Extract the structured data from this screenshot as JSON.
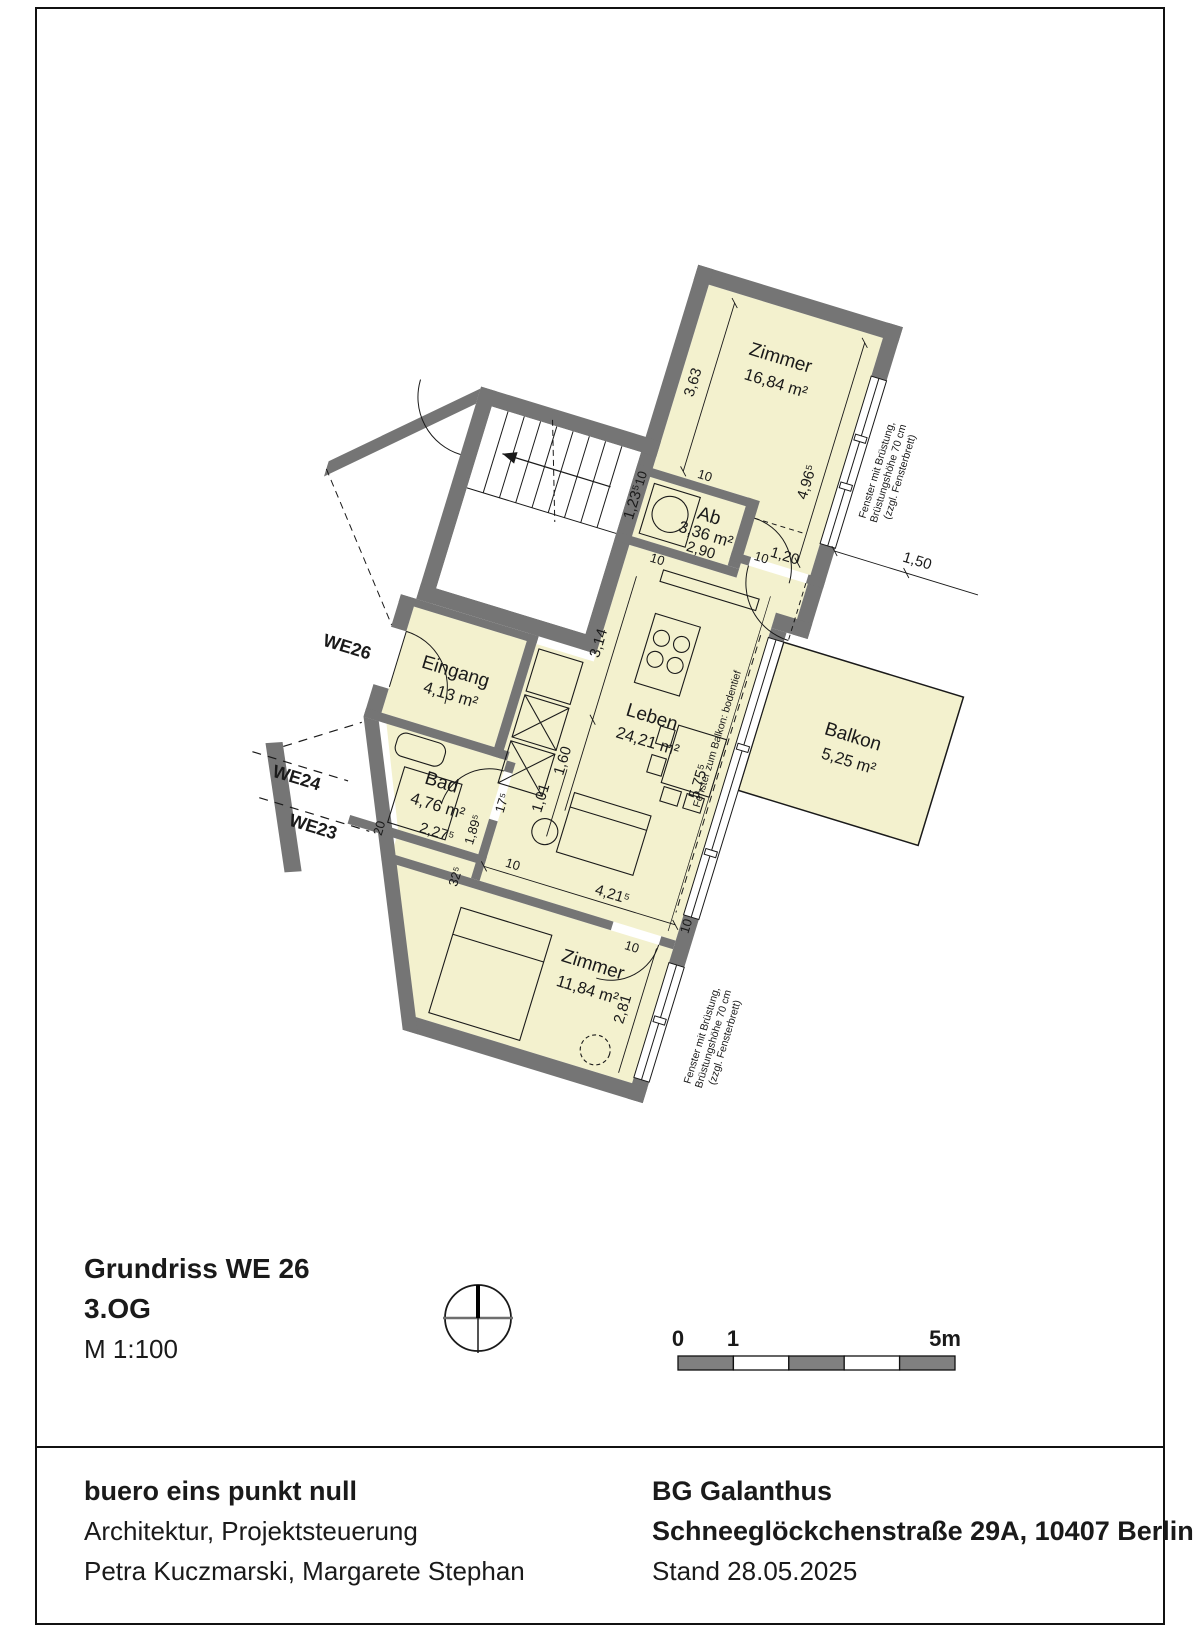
{
  "plan": {
    "rooms": [
      {
        "id": "zimmer1",
        "name": "Zimmer",
        "area": "16,84 m²"
      },
      {
        "id": "ab",
        "name": "Ab",
        "area": "3,36 m²"
      },
      {
        "id": "leben",
        "name": "Leben",
        "area": "24,21 m²"
      },
      {
        "id": "eingang",
        "name": "Eingang",
        "area": "4,13 m²"
      },
      {
        "id": "bad",
        "name": "Bad",
        "area": "4,76 m²"
      },
      {
        "id": "zimmer2",
        "name": "Zimmer",
        "area": "11,84 m²"
      },
      {
        "id": "balkon",
        "name": "Balkon",
        "area": "5,25 m²"
      }
    ],
    "dims": {
      "d363": "3,63",
      "d4965": "4,96⁵",
      "d1235": "1,23⁵",
      "d290": "2,90",
      "d120": "1,20",
      "d150": "1,50",
      "d314": "3,14",
      "d160": "1,60",
      "d101": "1,01",
      "d5755": "5,75⁵",
      "d175": "17⁵",
      "d1895": "1,89⁵",
      "d2275": "2,27⁵",
      "d20": "20",
      "d325": "32⁵",
      "d4215": "4,21⁵",
      "d281": "2,81"
    },
    "wall_dim": "10",
    "we_labels": {
      "we26": "WE26",
      "we24": "WE24",
      "we23": "WE23"
    },
    "window_note": {
      "l1": "Fenster mit Brüstung,",
      "l2": "Brüstungshöhe 70 cm",
      "l3": "(zzgl. Fensterbrett)"
    },
    "balcony_note": "Fenster zum Balkon: bodentief"
  },
  "titleblock": {
    "line1": "Grundriss WE 26",
    "line2": "3.OG",
    "line3": "M 1:100"
  },
  "scalebar": {
    "t0": "0",
    "t1": "1",
    "t5": "5m"
  },
  "footer": {
    "left1": "buero eins punkt null",
    "left2": "Architektur, Projektsteuerung",
    "left3": "Petra Kuczmarski, Margarete Stephan",
    "right1": "BG Galanthus",
    "right2": "Schneeglöckchenstraße 29A, 10407 Berlin",
    "right3": "Stand 28.05.2025"
  },
  "colors": {
    "room_fill": "#f3f1ce",
    "wall": "#757575",
    "line": "#1a1a1a"
  }
}
